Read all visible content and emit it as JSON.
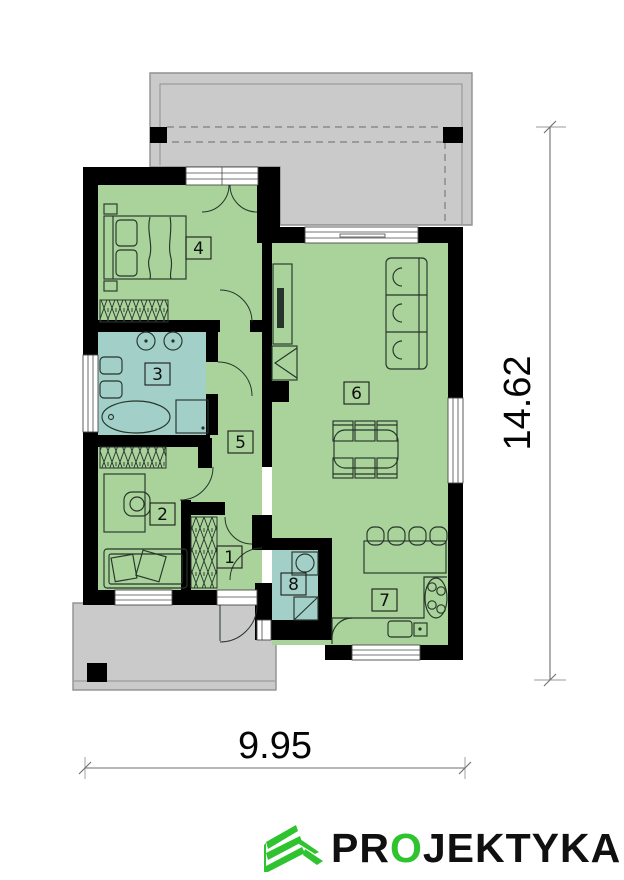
{
  "plan": {
    "rooms": [
      {
        "number": "1",
        "fill": "green"
      },
      {
        "number": "2",
        "fill": "green"
      },
      {
        "number": "3",
        "fill": "blue"
      },
      {
        "number": "4",
        "fill": "green"
      },
      {
        "number": "5",
        "fill": "green"
      },
      {
        "number": "6",
        "fill": "green"
      },
      {
        "number": "7",
        "fill": "green"
      },
      {
        "number": "8",
        "fill": "blue"
      }
    ],
    "dimensions": {
      "width_label": "9.95",
      "height_label": "14.62"
    },
    "colors": {
      "room_green": "#a9d39b",
      "room_blue": "#a3cfc9",
      "terrace": "#cacaca",
      "terrace_border": "#909090",
      "wall": "#000000",
      "furniture_line": "#27352a",
      "dimension_line": "#6e6e6e",
      "logo_green": "#2fc32f",
      "logo_text": "#101010"
    }
  },
  "logo": {
    "part1": "PR",
    "part2": "O",
    "part3": "JEKTYKA"
  }
}
